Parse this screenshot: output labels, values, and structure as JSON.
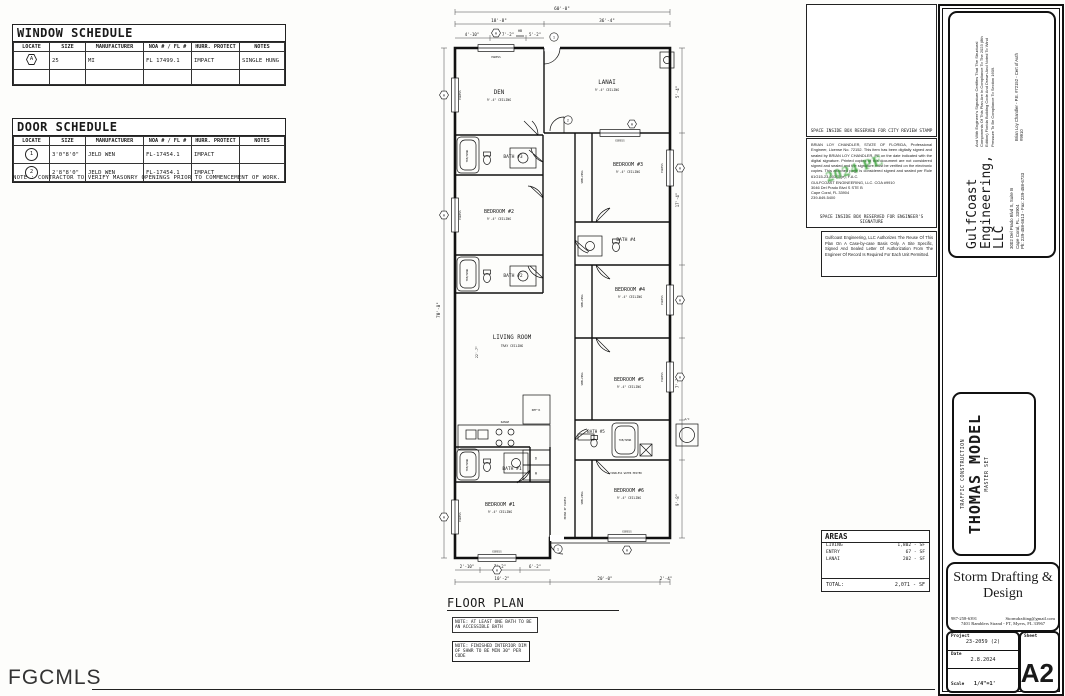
{
  "window_schedule": {
    "title": "WINDOW SCHEDULE",
    "headers": [
      "LOCATE",
      "SIZE",
      "MANUFACTURER",
      "NOA # / FL #",
      "HURR. PROTECT",
      "NOTES"
    ],
    "rows": [
      [
        "A",
        "25",
        "MI",
        "FL 17499.1",
        "IMPACT",
        "SINGLE HUNG"
      ]
    ]
  },
  "door_schedule": {
    "title": "DOOR SCHEDULE",
    "headers": [
      "LOCATE",
      "SIZE",
      "MANUFACTURER",
      "NOA # / FL #",
      "HURR. PROTECT",
      "NOTES"
    ],
    "rows": [
      [
        "1",
        "3'0\"8'0\"",
        "JELD WEN",
        "FL-17454.1",
        "IMPACT",
        ""
      ],
      [
        "2",
        "2'8\"8'0\"",
        "JELD WEN",
        "FL-17454.1",
        "IMPACT",
        ""
      ]
    ],
    "note": "NOTE : CONTRACTOR TO VERIFY MASONRY OPENINGS PRIOR TO COMMENCEMENT OF WORK."
  },
  "plan": {
    "title": "FLOOR PLAN",
    "notes": [
      "NOTE: AT LEAST ONE BATH TO BE AN ACCESSIBLE BATH",
      "NOTE: FINISHED INTERIOR DIM OF SHWR TO BE MIN 30\" PER CODE"
    ],
    "rooms": {
      "den": "DEN",
      "den_c": "9'-4\" CEILING",
      "lanai": "LANAI",
      "lanai_c": "9'-4\" CEILING",
      "bath3": "BATH #3",
      "bed2": "BEDROOM #2",
      "bed2_c": "9'-4\" CEILING",
      "bath2": "BATH #2",
      "living": "LIVING ROOM",
      "living_c": "TRAY CEILING",
      "bed3": "BEDROOM #3",
      "bed3_c": "9'-4\" CEILING",
      "bath4": "BATH #4",
      "bed4": "BEDROOM #4",
      "bed4_c": "9'-4\" CEILING",
      "bed5": "BEDROOM #5",
      "bed5_c": "9'-4\" CEILING",
      "bath5": "BATH #5",
      "bath1": "BATH #1",
      "bed1": "BEDROOM #1",
      "bed1_c": "9'-4\" CEILING",
      "bed6": "BEDROOM #6",
      "bed6_c": "9'-4\" CEILING"
    },
    "fixtures": {
      "tub": "TUB/SHWR",
      "range": "RANGE",
      "refr": "REF'R",
      "shelving": "SHELVING",
      "tankless": "TANKLESS WATER HEATER",
      "egress": "EGRESS",
      "means_of_egress": "MEANS OF EGRESS",
      "washer": "W",
      "dryer": "D",
      "ac": "A/C",
      "hb": "HB"
    },
    "dims": {
      "overall_width": "60'-0\"",
      "left_width": "18'-8\"",
      "right_width": "36'-4\"",
      "d1": "4'-10\"",
      "d2": "7'-2\"",
      "d3": "5'-2\"",
      "overall_height": "70'-8\"",
      "living_h": "22'-7\"",
      "r1": "5'-4\"",
      "r2": "17'-4\"",
      "r3": "7'-2\"",
      "r4": "9'-8\"",
      "b1": "2'-10\"",
      "b2": "7'-2\"",
      "b3": "6'-2\"",
      "b4": "10'-2\"",
      "b5": "20'-0\"",
      "b6": "2'-4\""
    },
    "markers": {
      "window": "A",
      "door1": "1",
      "door2": "2"
    }
  },
  "stamps": {
    "city": "SPACE INSIDE BOX RESERVED FOR CITY REVIEW STAMP",
    "engineer_para": "BRIAN LOY CHANDLER, STATE OF FLORIDA, Professional Engineer, License No. 72152. This item has been digitally signed and sealed by BRIAN LOY CHANDLER, PE on the date indicated with the digital signature. Printed copies of this document are not considered signed and sealed and the signature must be verified on the electronic copies. This attached page is considered signed and sealed per Rule 61G15-23-003(3)(e), F.A.C.",
    "gc_line1": "GULFCOAST ENGINEERING, LLC. COA #9910",
    "gc_line2": "3046 Del Prado Blvd S STE B",
    "gc_line3": "Cape Coral, FL 33904",
    "gc_line4": "239-849-5400",
    "engineer_resv": "SPACE INSIDE BOX RESERVED FOR ENGINEER'S SIGNATURE",
    "watermark": "2024 PE",
    "authorization": "Gulfcoast Engineering, LLC Authorizes The Reuse Of This Plan On A Case-by-case Basis Only.  A Site Specific, Signed And Sealed Letter Of Authorization From The Engineer Of Record Is Required For Each Unit Permitted."
  },
  "areas": {
    "title": "AREAS",
    "rows": [
      {
        "k": "LIVING",
        "v": "1,802 - SF"
      },
      {
        "k": "ENTRY",
        "v": "67 - SF"
      },
      {
        "k": "LANAI",
        "v": "202 - SF"
      }
    ],
    "total_label": "TOTAL:",
    "total": "2,071 - SF"
  },
  "title_block": {
    "cert": "And With Engineer's Signature Certifies That The Structural Components Of This Plan Are In Compliance To The 2023 (8th Edition) Florida Building Code And Drawn And Noted To Wind Pressure To Be Compliance To Section 1609.",
    "engineer_line": "Brian Loy Chandler - P.E. #72152 - Cert of Auth #9910",
    "company_l1": "GulfCoast",
    "company_l2": "Engineering,",
    "company_l3": "LLC",
    "addr1": "3002 Del Prado Blvd S, Suite B",
    "addr2": "Cape Coral, FL. 33904",
    "addr3": "Ph: 239-458-6613 - Fax: 239-458-6733",
    "builder": "TRAFFIC CONSTRUCTION",
    "model": "THOMAS MODEL",
    "set": "MASTER SET"
  },
  "storm": {
    "name": "Storm Drafting & Design",
    "phone": "987-258-6391",
    "email": "Stormdrafting@gmail.com",
    "address": "7401 Ramblers Strand - FT, Myers, FL 33967",
    "project_label": "Project",
    "project": "23-2059 (2)",
    "date_label": "Date",
    "date": "2.8.2024",
    "scale_label": "Scale",
    "scale": "1/4\"=1'",
    "sheet_label": "Sheet",
    "sheet": "A2"
  },
  "footer": {
    "brand": "FGCMLS"
  }
}
